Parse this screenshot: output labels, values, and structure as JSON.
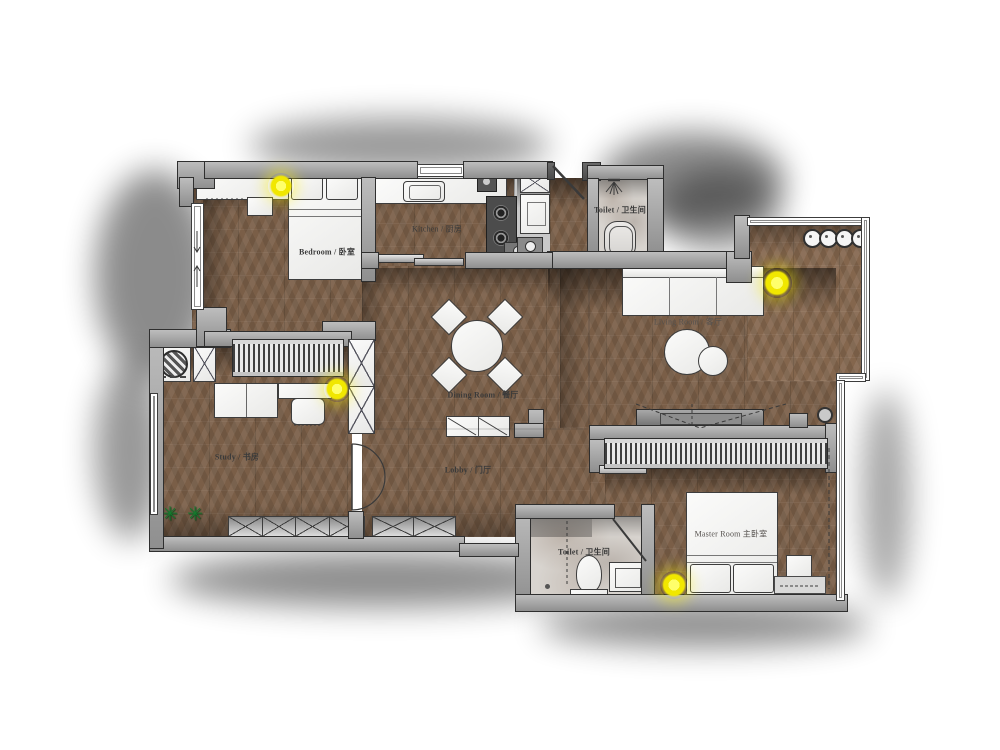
{
  "plan": {
    "type": "apartment-floor-plan-render",
    "rooms": [
      {
        "id": "bedroom",
        "label": "Bedroom / 卧室"
      },
      {
        "id": "kitchen",
        "label": "Kitchen / 厨房"
      },
      {
        "id": "toilet_top",
        "label": "Toilet / 卫生间"
      },
      {
        "id": "living_room",
        "label": "Living Room / 客厅"
      },
      {
        "id": "dining_room",
        "label": "Dining Room / 餐厅"
      },
      {
        "id": "study",
        "label": "Study / 书房"
      },
      {
        "id": "lobby",
        "label": "Lobby / 门厅"
      },
      {
        "id": "toilet_bottom",
        "label": "Toilet / 卫生间"
      },
      {
        "id": "master_room",
        "label": "Master Room 主卧室"
      }
    ],
    "colors": {
      "wall": "#9e9e9e",
      "wall_outline": "#2f2f2f",
      "wood_floor": "#7a5e47",
      "marble_floor": "#d8d4cf",
      "ceiling_light": "#f1e700",
      "plant": "#157a2d",
      "furniture": "#f3f3f2"
    },
    "counts": {
      "ceiling_lights": 4,
      "balcony_stools": 4,
      "plants": 2
    },
    "plant_glyph": "✳"
  }
}
